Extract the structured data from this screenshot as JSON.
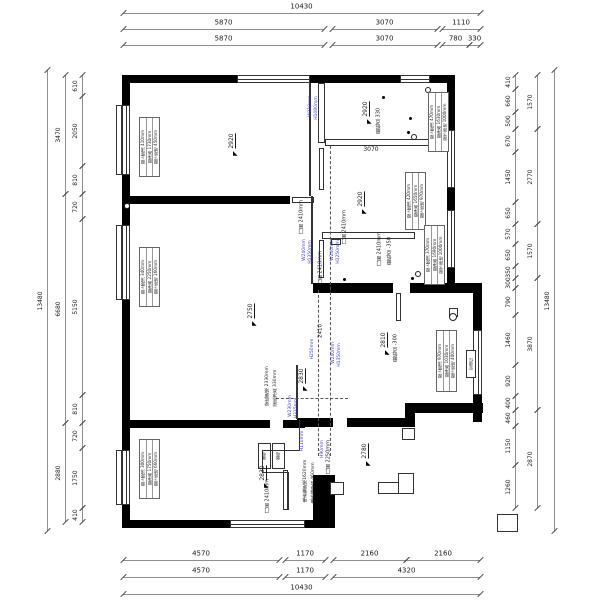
{
  "drawing": {
    "type": "residential-floor-plan",
    "units": "mm",
    "colors": {
      "wall": "#000000",
      "thin_line": "#333333",
      "dim_line": "#8f8f8f",
      "dim_text": "#1a1a1a",
      "beam_note": "#3b3bd0",
      "background": "#ffffff"
    },
    "dimensions": [
      {
        "o": "h",
        "pos": 13,
        "segs": [
          [
            "10430",
            123,
            480
          ]
        ]
      },
      {
        "o": "h",
        "pos": 29,
        "segs": [
          [
            "5870",
            123,
            324
          ],
          [
            "3070",
            332,
            437
          ],
          [
            "1110",
            442,
            480
          ]
        ]
      },
      {
        "o": "h",
        "pos": 45,
        "segs": [
          [
            "5870",
            123,
            324
          ],
          [
            "3070",
            332,
            437
          ],
          [
            "780",
            442,
            469
          ],
          [
            "330",
            469,
            480
          ]
        ]
      },
      {
        "o": "h",
        "pos": 560,
        "segs": [
          [
            "4570",
            123,
            279
          ],
          [
            "1170",
            285,
            325
          ],
          [
            "2160",
            333,
            406
          ],
          [
            "2160",
            406,
            480
          ]
        ]
      },
      {
        "o": "h",
        "pos": 577,
        "segs": [
          [
            "4570",
            123,
            279
          ],
          [
            "1170",
            285,
            325
          ],
          [
            "4320",
            333,
            480
          ]
        ]
      },
      {
        "o": "h",
        "pos": 594,
        "segs": [
          [
            "10430",
            123,
            480
          ]
        ]
      },
      {
        "o": "v",
        "pos": 47,
        "segs": [
          [
            "13480",
            70,
            531
          ]
        ]
      },
      {
        "o": "v",
        "pos": 65,
        "segs": [
          [
            "3470",
            75,
            194
          ],
          [
            "6680",
            194,
            423
          ],
          [
            "2880",
            423,
            522
          ]
        ]
      },
      {
        "o": "v",
        "pos": 82,
        "segs": [
          [
            "610",
            75,
            96
          ],
          [
            "2050",
            96,
            166
          ],
          [
            "810",
            166,
            194
          ],
          [
            "720",
            194,
            219
          ],
          [
            "5150",
            219,
            395
          ],
          [
            "810",
            395,
            423
          ],
          [
            "720",
            423,
            448
          ],
          [
            "1750",
            448,
            508
          ],
          [
            "410",
            508,
            522
          ]
        ]
      },
      {
        "o": "v",
        "pos": 515,
        "segs": [
          [
            "410",
            75,
            89
          ],
          [
            "660",
            89,
            112
          ],
          [
            "500",
            112,
            129
          ],
          [
            "670",
            129,
            152
          ],
          [
            "1450",
            152,
            202
          ],
          [
            "650",
            202,
            224
          ],
          [
            "570",
            224,
            244
          ],
          [
            "650",
            244,
            266
          ],
          [
            "350",
            266,
            278
          ],
          [
            "300",
            278,
            288
          ],
          [
            "790",
            288,
            315
          ],
          [
            "1460",
            315,
            365
          ],
          [
            "920",
            365,
            396
          ],
          [
            "400",
            396,
            410
          ],
          [
            "460",
            410,
            426
          ],
          [
            "1150",
            426,
            465
          ],
          [
            "1260",
            465,
            508
          ]
        ]
      },
      {
        "o": "v",
        "pos": 537,
        "segs": [
          [
            "1570",
            75,
            129
          ],
          [
            "2770",
            129,
            224
          ],
          [
            "1570",
            224,
            278
          ],
          [
            "3870",
            278,
            410
          ],
          [
            "2870",
            410,
            508
          ]
        ]
      },
      {
        "o": "v",
        "pos": 554,
        "segs": [
          [
            "13480",
            70,
            531
          ]
        ]
      }
    ],
    "labels": [
      {
        "t": "2920",
        "x": 232,
        "y": 141,
        "r": 90,
        "s": 6,
        "arrow": true,
        "name": "ceiling-height-bedroom1"
      },
      {
        "t": "2920",
        "x": 366,
        "y": 109,
        "r": 90,
        "s": 6,
        "arrow": true,
        "name": "ceiling-height-bath"
      },
      {
        "t": "2920",
        "x": 361,
        "y": 199,
        "r": 90,
        "s": 6,
        "arrow": true,
        "name": "ceiling-height-room-b"
      },
      {
        "t": "2750",
        "x": 251,
        "y": 311,
        "r": 90,
        "s": 6,
        "arrow": true,
        "name": "ceiling-height-living"
      },
      {
        "t": "2830",
        "x": 302,
        "y": 376,
        "r": 90,
        "s": 6,
        "arrow": true,
        "name": "ceiling-height-hall"
      },
      {
        "t": "2830",
        "x": 263,
        "y": 473,
        "r": 90,
        "s": 6,
        "arrow": true,
        "name": "ceiling-height-bedroom2"
      },
      {
        "t": "2810",
        "x": 384,
        "y": 340,
        "r": 90,
        "s": 6,
        "arrow": true,
        "name": "ceiling-height-dining"
      },
      {
        "t": "2780",
        "x": 365,
        "y": 451,
        "r": 90,
        "s": 6,
        "arrow": true,
        "name": "ceiling-height-balcony"
      },
      {
        "t": "2410",
        "x": 321,
        "y": 331,
        "r": 90,
        "s": 5.5,
        "name": "corridor-dim"
      },
      {
        "t": "3070",
        "x": 371,
        "y": 150,
        "r": 0,
        "s": 6,
        "name": "internal-dim-3070"
      },
      {
        "t": "最低点 330",
        "x": 379,
        "y": 121,
        "r": 90,
        "s": 5,
        "name": "min-point-bath"
      },
      {
        "t": "最低点 -350",
        "x": 390,
        "y": 251,
        "r": 90,
        "s": 5,
        "name": "min-point-room-b"
      },
      {
        "t": "最低点 -300",
        "x": 396,
        "y": 348,
        "r": 90,
        "s": 5,
        "name": "min-point-dining"
      },
      {
        "t": "门高 2410mm",
        "x": 302,
        "y": 217,
        "r": 90,
        "s": 5,
        "name": "door-height-label"
      },
      {
        "t": "门高 2410mm",
        "x": 345,
        "y": 227,
        "r": 90,
        "s": 5,
        "name": "door-height-label"
      },
      {
        "t": "门高 2410mm",
        "x": 380,
        "y": 249,
        "r": 90,
        "s": 5,
        "name": "door-height-label"
      },
      {
        "t": "门高 2410mm",
        "x": 321,
        "y": 268,
        "r": 90,
        "s": 5,
        "name": "door-height-label"
      },
      {
        "t": "门高 2250mm",
        "x": 329,
        "y": 457,
        "r": 90,
        "s": 5,
        "name": "door-height-label"
      },
      {
        "t": "门高 2410mm",
        "x": 268,
        "y": 496,
        "r": 90,
        "s": 5,
        "name": "door-height-label"
      },
      {
        "t": "电表箱距地1620mm",
        "x": 306,
        "y": 481,
        "r": 90,
        "s": 4.5,
        "name": "meter-box-height-label"
      },
      {
        "t": "电表箱净高 460mm",
        "x": 314,
        "y": 483,
        "r": 90,
        "s": 4.5,
        "name": "meter-box-size-label"
      },
      {
        "t": "强电",
        "x": 264,
        "y": 456,
        "r": 90,
        "s": 4,
        "name": "strong-elec-box-label"
      },
      {
        "t": "弱电",
        "x": 278,
        "y": 456,
        "r": 90,
        "s": 4,
        "name": "weak-elec-box-label"
      },
      {
        "t": "空调位",
        "x": 471,
        "y": 364,
        "r": 90,
        "s": 4,
        "name": "ac-unit-label"
      },
      {
        "t": "梁底距地 2330mm",
        "x": 268,
        "y": 386,
        "r": 90,
        "s": 4.5,
        "name": "beam-note-label"
      },
      {
        "t": "梁底净高 330mm",
        "x": 276,
        "y": 388,
        "r": 90,
        "s": 4.5,
        "name": "beam-note-label"
      },
      {
        "t": "W210mm",
        "x": 311,
        "y": 106,
        "r": 90,
        "s": 4.5,
        "c": "b",
        "name": "beam-size-label"
      },
      {
        "t": "H1080mm",
        "x": 317,
        "y": 108,
        "r": 90,
        "s": 4.5,
        "c": "b",
        "name": "beam-size-label"
      },
      {
        "t": "W240mm",
        "x": 305,
        "y": 250,
        "r": 90,
        "s": 4.5,
        "c": "b",
        "name": "beam-size-label"
      },
      {
        "t": "H1350mm",
        "x": 311,
        "y": 252,
        "r": 90,
        "s": 4.5,
        "c": "b",
        "name": "beam-size-label"
      },
      {
        "t": "W240mm",
        "x": 333,
        "y": 250,
        "r": 90,
        "s": 4.5,
        "c": "b",
        "name": "beam-size-label"
      },
      {
        "t": "H1250mm",
        "x": 339,
        "y": 252,
        "r": 90,
        "s": 4.5,
        "c": "b",
        "name": "beam-size-label"
      },
      {
        "t": "H250mm",
        "x": 313,
        "y": 349,
        "r": 90,
        "s": 4.5,
        "c": "b",
        "name": "beam-size-label"
      },
      {
        "t": "W240mm",
        "x": 334,
        "y": 353,
        "r": 90,
        "s": 4.5,
        "c": "b",
        "name": "beam-size-label"
      },
      {
        "t": "H1350mm",
        "x": 340,
        "y": 355,
        "r": 90,
        "s": 4.5,
        "c": "b",
        "name": "beam-size-label"
      },
      {
        "t": "W230mm",
        "x": 291,
        "y": 406,
        "r": 90,
        "s": 4.5,
        "c": "b",
        "name": "beam-size-label"
      },
      {
        "t": "H335mm",
        "x": 297,
        "y": 408,
        "r": 90,
        "s": 4.5,
        "c": "b",
        "name": "beam-size-label"
      },
      {
        "t": "H110mm",
        "x": 303,
        "y": 441,
        "r": 90,
        "s": 4.5,
        "c": "b",
        "name": "beam-size-label"
      },
      {
        "t": "H90mm",
        "x": 323,
        "y": 449,
        "r": 90,
        "s": 4.5,
        "c": "b",
        "name": "beam-size-label"
      }
    ],
    "window_boxes": [
      {
        "x": 139,
        "y": 117,
        "w": 21,
        "h": 60,
        "lines": [
          "窗上距顶 410mm",
          "窗净高 1730mm",
          "窗下距地 450mm"
        ],
        "name": "window-info-bedroom1"
      },
      {
        "x": 139,
        "y": 247,
        "w": 21,
        "h": 60,
        "lines": [
          "窗上距顶 340mm",
          "窗净高 2250mm",
          "窗下距地 160mm"
        ],
        "name": "window-info-living"
      },
      {
        "x": 139,
        "y": 439,
        "w": 21,
        "h": 60,
        "lines": [
          "窗上距顶 300mm",
          "窗净高 1750mm",
          "窗下距地 660mm"
        ],
        "name": "window-info-bedroom2"
      },
      {
        "x": 428,
        "y": 92,
        "w": 21,
        "h": 60,
        "lines": [
          "窗上距顶 470mm",
          "窗净高 1630mm",
          "窗下距地 1000mm"
        ],
        "name": "window-info-bath"
      },
      {
        "x": 405,
        "y": 172,
        "w": 21,
        "h": 58,
        "lines": [
          "窗上距顶 420mm",
          "窗净高 1650mm",
          "窗下距地 970mm"
        ],
        "name": "window-info-room-b-top"
      },
      {
        "x": 424,
        "y": 225,
        "w": 21,
        "h": 60,
        "lines": [
          "窗上距顶 370mm",
          "窗净高 1690mm",
          "窗下距地 1000mm"
        ],
        "name": "window-info-room-b"
      },
      {
        "x": 436,
        "y": 330,
        "w": 21,
        "h": 62,
        "lines": [
          "窗上距顶 970mm",
          "窗净高 1030mm",
          "窗下距地 400mm"
        ],
        "name": "window-info-dining"
      }
    ],
    "geometry": {
      "walls": [
        [
          122,
          75,
          115,
          8
        ],
        [
          310,
          75,
          90,
          8
        ],
        [
          430,
          75,
          25,
          8
        ],
        [
          122,
          75,
          8,
          30
        ],
        [
          122,
          175,
          8,
          50
        ],
        [
          122,
          300,
          8,
          150
        ],
        [
          122,
          505,
          8,
          23
        ],
        [
          122,
          520,
          108,
          8
        ],
        [
          305,
          520,
          30,
          8
        ],
        [
          447,
          75,
          8,
          55
        ],
        [
          447,
          188,
          8,
          22
        ],
        [
          447,
          268,
          8,
          23
        ],
        [
          313,
          283,
          80,
          10
        ],
        [
          410,
          283,
          72,
          10
        ],
        [
          473,
          283,
          9,
          47
        ],
        [
          473,
          395,
          9,
          27
        ],
        [
          405,
          403,
          78,
          10
        ],
        [
          405,
          403,
          10,
          24
        ],
        [
          297,
          418,
          36,
          9
        ],
        [
          347,
          418,
          61,
          9
        ],
        [
          122,
          196,
          168,
          8
        ],
        [
          122,
          420,
          148,
          8
        ],
        [
          283,
          420,
          22,
          8
        ],
        [
          313,
          475,
          22,
          45
        ]
      ],
      "wins": [
        [
          237,
          75,
          73,
          8,
          "h"
        ],
        [
          400,
          75,
          30,
          8,
          "h"
        ],
        [
          122,
          105,
          8,
          70,
          "v"
        ],
        [
          122,
          225,
          8,
          75,
          "v"
        ],
        [
          122,
          450,
          8,
          55,
          "v"
        ],
        [
          230,
          520,
          75,
          8,
          "h"
        ],
        [
          447,
          130,
          8,
          58,
          "v"
        ],
        [
          447,
          210,
          8,
          58,
          "v"
        ],
        [
          473,
          330,
          9,
          65,
          "v"
        ]
      ],
      "boxes": [
        [
          318,
          83,
          7,
          60
        ],
        [
          325,
          139,
          122,
          7
        ],
        [
          322,
          232,
          93,
          7
        ],
        [
          331,
          239,
          10,
          6
        ],
        [
          319,
          148,
          5,
          42
        ],
        [
          319,
          240,
          5,
          38
        ],
        [
          283,
          470,
          5,
          40
        ],
        [
          396,
          293,
          5,
          28
        ],
        [
          292,
          197,
          22,
          6
        ],
        [
          402,
          428,
          13,
          12
        ],
        [
          330,
          482,
          14,
          13
        ],
        [
          378,
          482,
          36,
          12
        ],
        [
          398,
          473,
          16,
          21
        ],
        [
          497,
          514,
          21,
          18
        ],
        [
          258,
          443,
          13,
          26
        ],
        [
          272,
          443,
          13,
          26
        ],
        [
          466,
          350,
          10,
          28
        ],
        [
          449,
          308,
          9,
          9
        ],
        [
          116,
          105,
          6,
          70
        ],
        [
          116,
          225,
          6,
          75
        ],
        [
          116,
          450,
          6,
          55
        ]
      ],
      "lines": [
        [
          309,
          83,
          2,
          113
        ],
        [
          311,
          196,
          2,
          88
        ],
        [
          296,
          365,
          2,
          54
        ],
        [
          299,
          420,
          1,
          30
        ],
        [
          262,
          450,
          38,
          1
        ],
        [
          262,
          450,
          1,
          22
        ],
        [
          262,
          472,
          26,
          1
        ],
        [
          288,
          472,
          1,
          38
        ]
      ],
      "dashes": [
        [
          330,
          146,
          310,
          "v"
        ],
        [
          318,
          290,
          166,
          "v"
        ],
        [
          276,
          398,
          72,
          "h"
        ]
      ],
      "circles": [
        [
          127,
          206,
          3
        ],
        [
          428,
          90,
          3
        ],
        [
          414,
          137,
          3
        ],
        [
          418,
          274,
          3
        ],
        [
          453,
          317,
          4
        ]
      ],
      "dots": [
        [
          383,
          97
        ],
        [
          410,
          118
        ],
        [
          408,
          132
        ],
        [
          344,
          279
        ],
        [
          412,
          278
        ]
      ]
    }
  }
}
